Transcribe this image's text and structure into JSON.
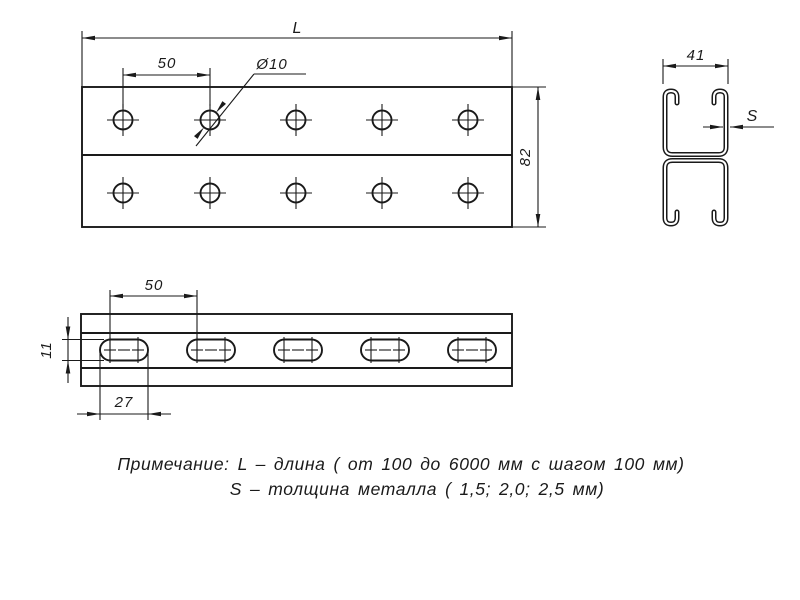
{
  "drawing": {
    "background": "#ffffff",
    "line_color": "#1a1a1a",
    "top_view": {
      "length_label": "L",
      "hole_spacing_label": "50",
      "hole_diameter_label": "Ø10",
      "height_label": "82"
    },
    "section_view": {
      "width_label": "41",
      "thickness_label": "S"
    },
    "side_view": {
      "slot_spacing_label": "50",
      "slot_height_label": "11",
      "slot_length_label": "27"
    },
    "note": {
      "line1": "Примечание: L – длина ( от 100 до 6000 мм с шагом 100 мм)",
      "line2": "S – толщина металла ( 1,5; 2,0; 2,5 мм)"
    }
  }
}
